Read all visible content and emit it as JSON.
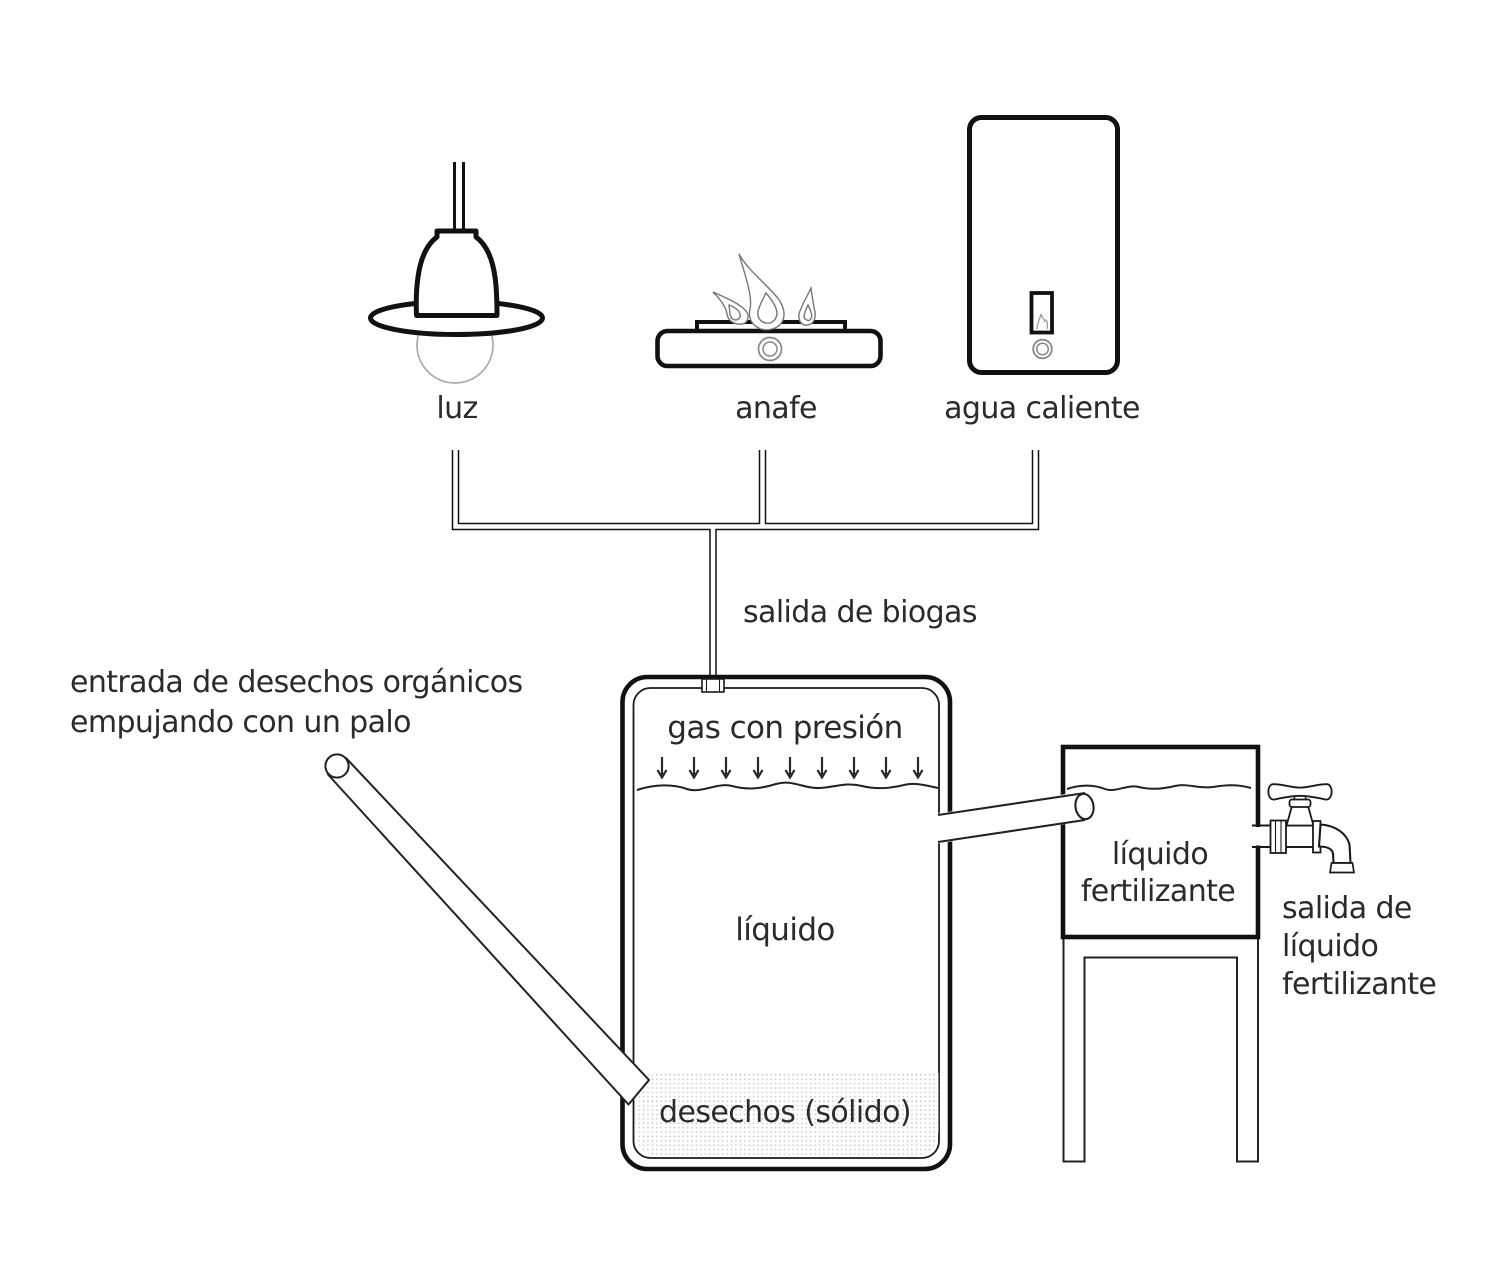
{
  "diagram": {
    "title_implicit": "biodigester diagram",
    "appliances": {
      "lamp": "luz",
      "stove": "anafe",
      "water_heater": "agua caliente"
    },
    "biogas_outlet": "salida de biogas",
    "inlet": {
      "line1": "entrada de desechos orgánicos",
      "line2": "empujando con un palo"
    },
    "digester": {
      "gas": "gas con presión",
      "liquid": "líquido",
      "solids": "desechos (sólido)",
      "pressure_arrows_count": 9
    },
    "fertilizer_tank": {
      "line1": "líquido",
      "line2": "fertilizante"
    },
    "fertilizer_outlet": {
      "line1": "salida de",
      "line2": "líquido",
      "line3": "fertilizante"
    },
    "colors": {
      "ink": "#111111",
      "text": "#2b2b2b",
      "soft_gray": "#8a8a8a",
      "bulb_gray": "#aaaaaa",
      "dot_fill": "#c8c8c8"
    }
  }
}
